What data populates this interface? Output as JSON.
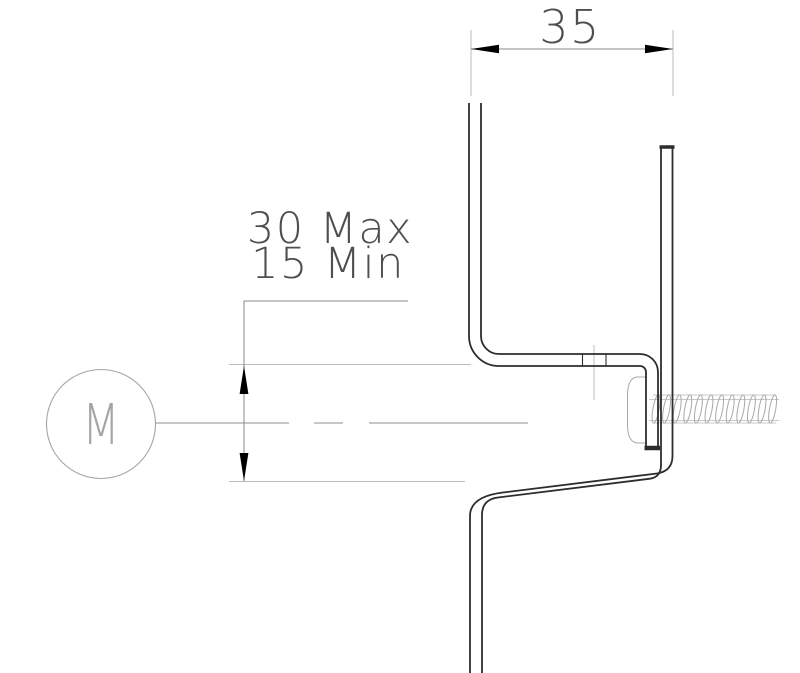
{
  "drawing": {
    "labels": {
      "width": "35",
      "height_max": "30 Max",
      "height_min": "15 Min",
      "motor": "M"
    },
    "colors": {
      "outline": "#2d2d2d",
      "dimension_line": "#8a8a8a",
      "extension_line": "#bdbdbd",
      "centerline": "#8f8f8f",
      "screw": "#a8a8a8",
      "screw_light": "#c9c9c9",
      "text": "#4f4f4f",
      "motor": "#a5a5a5",
      "arrow_fill": "#000000",
      "background": "#ffffff"
    }
  }
}
